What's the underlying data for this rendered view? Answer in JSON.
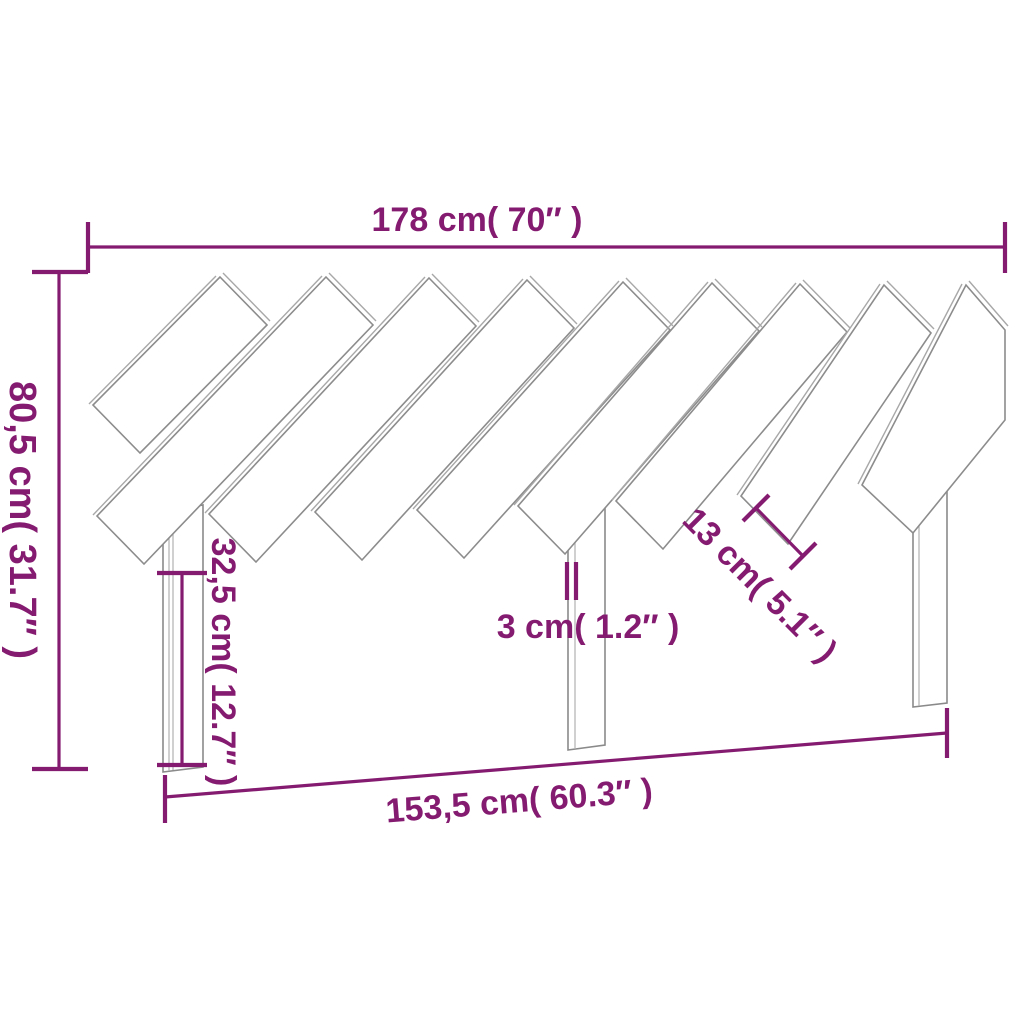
{
  "diagram": {
    "title": "Headboard dimension diagram",
    "product": "slatted-headboard",
    "colors": {
      "dimension": "#851B70",
      "outline": "#8C8C8C",
      "background": "#FFFFFF"
    },
    "dimensions": {
      "overall_width": {
        "label": "178 cm( 70″ )"
      },
      "overall_height": {
        "label": "80,5 cm( 31.7″ )"
      },
      "leg_height": {
        "label": "32,5 cm( 12.7″ )"
      },
      "slat_thickness": {
        "label": "3 cm( 1.2″ )"
      },
      "slat_width": {
        "label": "13 cm( 5.1″ )"
      },
      "inner_width": {
        "label": "153,5 cm( 60.3″ )"
      }
    }
  }
}
